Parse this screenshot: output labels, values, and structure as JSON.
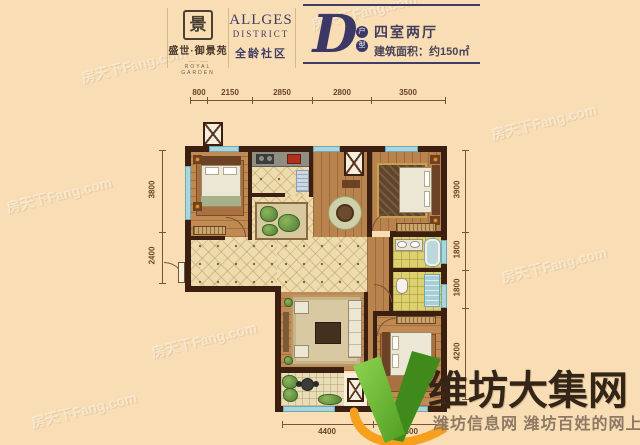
{
  "header": {
    "brand": {
      "seal_char": "景",
      "name": "盛世·御景苑",
      "divider": "—— · ——",
      "english": "ROYAL GARDEN"
    },
    "district": {
      "line1": "ALLGES",
      "line2": "DISTRICT",
      "cn": "全龄社区"
    },
    "unit": {
      "letter": "D",
      "tag_top": "户",
      "tag_bottom": "型",
      "type": "四室两厅",
      "area": "建筑面积：约150㎡"
    }
  },
  "floorplan": {
    "dimensions": {
      "top": [
        "800",
        "2150",
        "2850",
        "2800",
        "3500"
      ],
      "left": [
        "3800",
        "2400"
      ],
      "right": [
        "3900",
        "1800",
        "1800",
        "4200"
      ],
      "bottom": [
        "4400",
        "3500"
      ]
    }
  },
  "watermarks": {
    "text": "房天下Fang.com"
  },
  "site_logo": {
    "title": "维坊大集网",
    "subtitle": "潍坊信息网 潍坊百姓的网上大集",
    "green": "#57a527",
    "orange": "#f6a01d"
  },
  "colors": {
    "background": "#f8ddb5",
    "wall": "#3b1f10",
    "header_navy": "#3f3c66",
    "window_blue": "#a9d5dc",
    "dimension_text": "#6b4428"
  }
}
